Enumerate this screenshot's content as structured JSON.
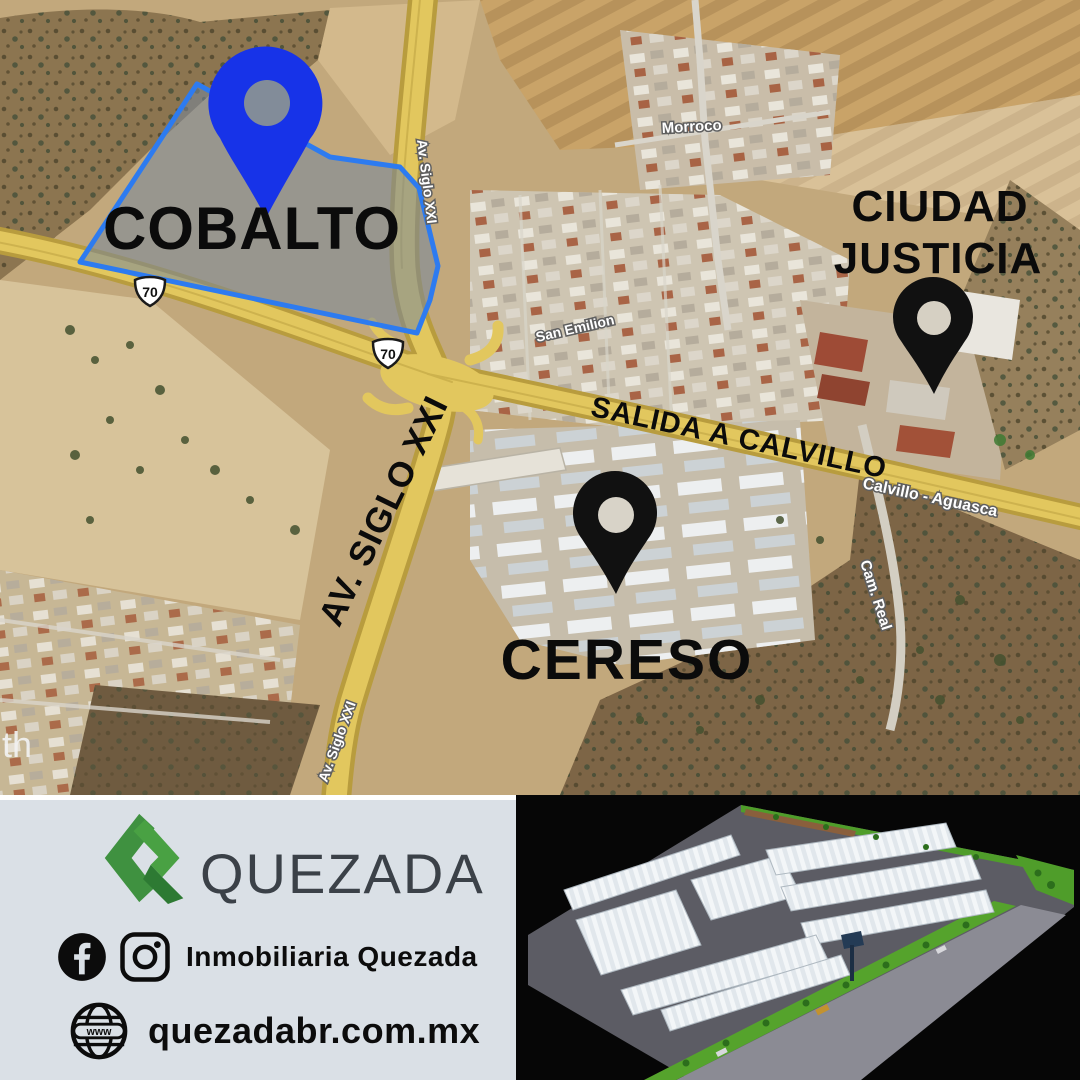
{
  "map": {
    "area_labels": {
      "cobalto": "COBALTO",
      "ciudad_line1": "CIUDAD",
      "ciudad_line2": "JUSTICIA",
      "cereso": "CERESO",
      "salida": "SALIDA A CALVILLO",
      "av_siglo_big": "AV. SIGLO XXI"
    },
    "road_labels": {
      "av_siglo_top": "Av. Siglo XXI",
      "av_siglo_bottom": "Av. Siglo XXI",
      "morroco": "Morroco",
      "san_emilion": "San Emilion",
      "calvillo": "Calvillo - Aguasca",
      "cam_real": "Cam. Real"
    },
    "watermark_fragment": "th",
    "shields": [
      {
        "number": "70"
      },
      {
        "number": "70"
      }
    ],
    "colors": {
      "pin_blue": "#1733e8",
      "pin_black": "#111111",
      "parcel_stroke": "#2d7bf0",
      "road_yellow": "#e2c75e"
    }
  },
  "footer": {
    "brand": {
      "name": "QUEZADA",
      "accent_green": "#3f9140"
    },
    "social": {
      "handle": "Inmobiliaria Quezada"
    },
    "website": {
      "url": "quezadabr.com.mx",
      "globe_label": "www"
    }
  }
}
